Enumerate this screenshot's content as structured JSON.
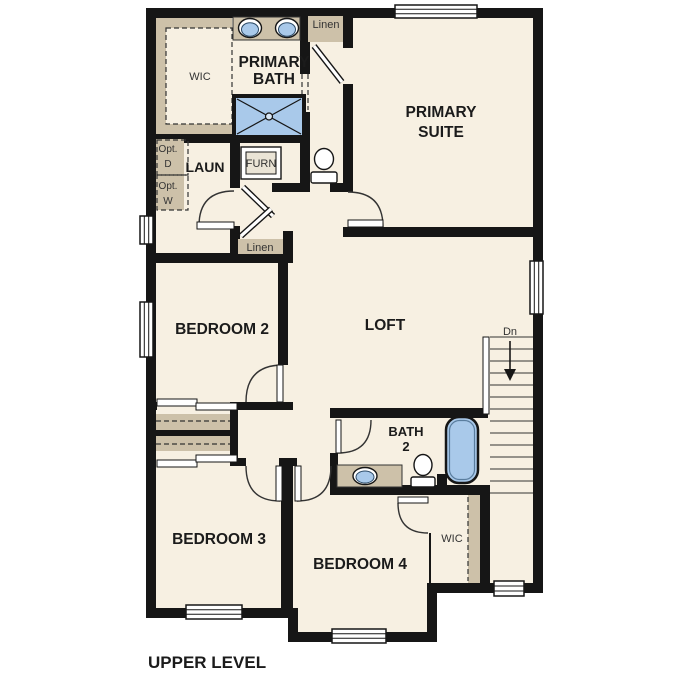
{
  "title": "UPPER LEVEL",
  "colors": {
    "wall": "#161616",
    "floor": "#f7f0e2",
    "tan": "#cdc1a9",
    "fixture_blue": "#a9c9ea",
    "paper": "#ffffff"
  },
  "rooms": {
    "primary_suite": [
      "PRIMARY",
      "SUITE"
    ],
    "primary_bath": [
      "PRIMARY",
      "BATH"
    ],
    "wic_primary": "WIC",
    "laundry": "LAUN",
    "furnace": "FURN",
    "linen_upper": "Linen",
    "linen_hall": "Linen",
    "bedroom2": "BEDROOM 2",
    "bedroom3": "BEDROOM 3",
    "bedroom4": "BEDROOM 4",
    "loft": "LOFT",
    "bath2": [
      "BATH",
      "2"
    ],
    "wic_bedroom4": "WIC"
  },
  "annotations": {
    "stairs_down": "Dn",
    "opt_dryer": [
      "Opt.",
      "D"
    ],
    "opt_washer": [
      "Opt.",
      "W"
    ]
  }
}
